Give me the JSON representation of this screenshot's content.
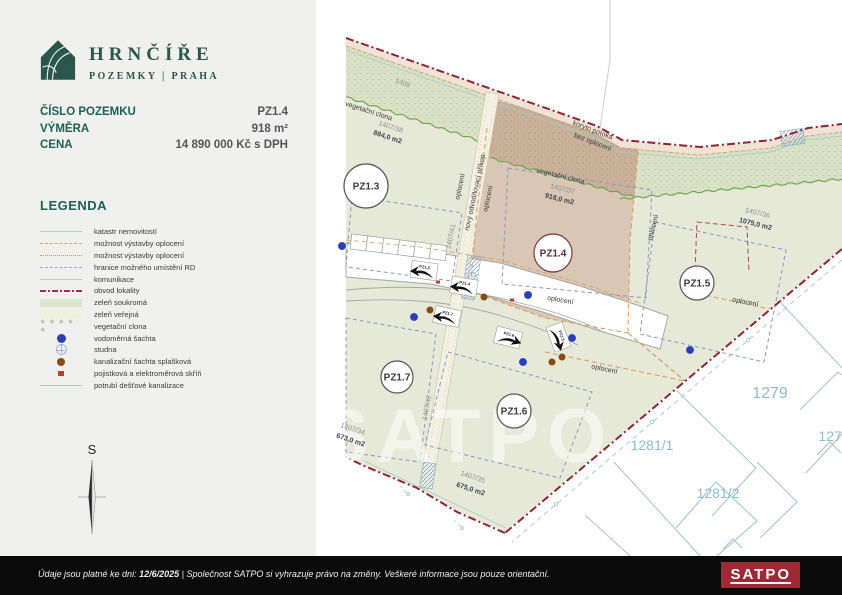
{
  "brand": {
    "name": "HRNČÍŘE",
    "subtitle": "POZEMKY | PRAHA"
  },
  "info": {
    "rows": [
      {
        "label": "ČÍSLO POZEMKU",
        "value": "PZ1.4"
      },
      {
        "label": "VÝMĚRA",
        "value": "918 m²"
      },
      {
        "label": "CENA",
        "value": "14 890 000 Kč s DPH"
      }
    ]
  },
  "legend": {
    "title": "LEGENDA",
    "items": [
      {
        "swatch": "line-cyan",
        "label": "katastr nemovitostí"
      },
      {
        "swatch": "line-orange-dash",
        "label": "možnost výstavby oplocení"
      },
      {
        "swatch": "line-orange-dot",
        "label": "možnost výstavby oplocení"
      },
      {
        "swatch": "line-blue-dash",
        "label": "hranice možného umístění RD"
      },
      {
        "swatch": "line-gray",
        "label": "komunikace"
      },
      {
        "swatch": "line-dashdot",
        "label": "obvod lokality"
      },
      {
        "swatch": "fill-private",
        "label": "zeleň soukromá"
      },
      {
        "swatch": "fill-public",
        "label": "zeleň veřejná"
      },
      {
        "swatch": "stars",
        "label": "vegetační clona"
      },
      {
        "swatch": "dot-blue",
        "label": "vodoměrná šachta"
      },
      {
        "swatch": "circle-cross",
        "label": "studna"
      },
      {
        "swatch": "dot-brown",
        "label": "kanalizační šachta splašková"
      },
      {
        "swatch": "square-red",
        "label": "pojistková a elektroměrová skříň"
      },
      {
        "swatch": "line-lightgray",
        "label": "potrubí dešťové kanalizace"
      }
    ]
  },
  "compass": {
    "label": "S"
  },
  "footer": {
    "prefix": "Údaje jsou platné ke dni: ",
    "date": "12/6/2025",
    "suffix": " | Společnost SATPO si vyhrazuje právo na změny. Veškeré informace jsou pouze orientační.",
    "logo": "SATPO"
  },
  "map": {
    "watermark": "SATPO",
    "colors": {
      "brand_green": "#2a564c",
      "teal": "#1d6057",
      "locality_green": "#e6e9d8",
      "selected_plot": "#d9c6b4",
      "boundary_red": "#8e2430",
      "cadastre_blue": "#9dc3d2",
      "satpo_red": "#9e2833",
      "water_blue": "#2a3fb8",
      "sewer_brown": "#8a4a15"
    },
    "plot_circles": [
      {
        "id": "PZ1.3",
        "x": 366,
        "y": 186,
        "r": 22,
        "accent": false
      },
      {
        "id": "PZ1.4",
        "x": 553,
        "y": 253,
        "r": 19,
        "accent": true
      },
      {
        "id": "PZ1.5",
        "x": 697,
        "y": 283,
        "r": 17,
        "accent": false
      },
      {
        "id": "PZ1.6",
        "x": 514,
        "y": 411,
        "r": 17,
        "accent": false
      },
      {
        "id": "PZ1.7",
        "x": 397,
        "y": 377,
        "r": 16,
        "accent": false
      }
    ],
    "labels": [
      {
        "text": "1408",
        "x": 402,
        "y": 85,
        "rot": 20,
        "cls": "num",
        "size": 8
      },
      {
        "text": "vegetační clona",
        "x": 368,
        "y": 113,
        "rot": 18,
        "cls": "feature"
      },
      {
        "text": "1407/38",
        "x": 390,
        "y": 129,
        "rot": 18,
        "cls": "num"
      },
      {
        "text": "884,0 m2",
        "x": 387,
        "y": 139,
        "rot": 18,
        "cls": "area"
      },
      {
        "text": "koryto potoka",
        "x": 592,
        "y": 132,
        "rot": 21,
        "cls": "feature",
        "size": 7.5
      },
      {
        "text": "bez oplocení",
        "x": 592,
        "y": 144,
        "rot": 21,
        "cls": "feature",
        "size": 7.5
      },
      {
        "text": "vegetační clona",
        "x": 560,
        "y": 178,
        "rot": 14,
        "cls": "feature"
      },
      {
        "text": "1407/37",
        "x": 562,
        "y": 191,
        "rot": 14,
        "cls": "num"
      },
      {
        "text": "918,0 m2",
        "x": 559,
        "y": 201,
        "rot": 14,
        "cls": "area"
      },
      {
        "text": "1407/36",
        "x": 757,
        "y": 215,
        "rot": 14,
        "cls": "num"
      },
      {
        "text": "1075,0 m2",
        "x": 755,
        "y": 226,
        "rot": 14,
        "cls": "area"
      },
      {
        "text": "oplocení",
        "x": 462,
        "y": 187,
        "rot": -78,
        "cls": "feature"
      },
      {
        "text": "nový odvodňovací příkop",
        "x": 477,
        "y": 193,
        "rot": -78,
        "cls": "feature",
        "size": 6.5
      },
      {
        "text": "oplocení",
        "x": 490,
        "y": 199,
        "rot": -78,
        "cls": "feature"
      },
      {
        "text": "1407/41",
        "x": 453,
        "y": 237,
        "rot": -78,
        "cls": "num",
        "size": 6.5
      },
      {
        "text": "oplocení",
        "x": 655,
        "y": 228,
        "rot": -75,
        "cls": "feature"
      },
      {
        "text": "oplocení",
        "x": 560,
        "y": 302,
        "rot": 10,
        "cls": "feature"
      },
      {
        "text": "oplocení",
        "x": 745,
        "y": 304,
        "rot": 11,
        "cls": "feature"
      },
      {
        "text": "oplocení",
        "x": 604,
        "y": 371,
        "rot": 12,
        "cls": "feature"
      },
      {
        "text": "1407/42",
        "x": 429,
        "y": 408,
        "rot": -80,
        "cls": "num",
        "size": 6.5
      },
      {
        "text": "1407/34",
        "x": 352,
        "y": 431,
        "rot": 18,
        "cls": "num"
      },
      {
        "text": "673,0 m2",
        "x": 350,
        "y": 442,
        "rot": 18,
        "cls": "area"
      },
      {
        "text": "1407/35",
        "x": 472,
        "y": 479,
        "rot": 18,
        "cls": "num"
      },
      {
        "text": "675,0 m2",
        "x": 470,
        "y": 491,
        "rot": 18,
        "cls": "area"
      },
      {
        "text": "1279",
        "x": 770,
        "y": 398,
        "rot": 0,
        "cls": "cad-big"
      },
      {
        "text": "1281/1",
        "x": 652,
        "y": 450,
        "rot": 0,
        "cls": "cad"
      },
      {
        "text": "1281/2",
        "x": 718,
        "y": 498,
        "rot": 0,
        "cls": "cad"
      },
      {
        "text": "1277",
        "x": 834,
        "y": 441,
        "rot": 0,
        "cls": "cad"
      }
    ],
    "driveway_arrows": [
      {
        "id": "PZ1.3",
        "x": 424,
        "y": 271,
        "rot": 8,
        "flip": true
      },
      {
        "id": "PZ1.4",
        "x": 464,
        "y": 287,
        "rot": 10,
        "flip": true
      },
      {
        "id": "PZ1.7",
        "x": 447,
        "y": 317,
        "rot": 12,
        "flip": true
      },
      {
        "id": "PZ1.6",
        "x": 508,
        "y": 338,
        "rot": 14,
        "flip": false
      },
      {
        "id": "PZ1.5",
        "x": 558,
        "y": 337,
        "rot": 70,
        "flip": false
      }
    ],
    "water_shafts": [
      [
        342,
        246
      ],
      [
        414,
        317
      ],
      [
        528,
        295
      ],
      [
        572,
        338
      ],
      [
        690,
        350
      ],
      [
        523,
        362
      ]
    ],
    "sewer_shafts": [
      [
        430,
        310
      ],
      [
        484,
        297
      ],
      [
        552,
        362
      ],
      [
        562,
        357
      ]
    ],
    "meter_boxes": [
      [
        438,
        282
      ],
      [
        512,
        300
      ]
    ]
  }
}
